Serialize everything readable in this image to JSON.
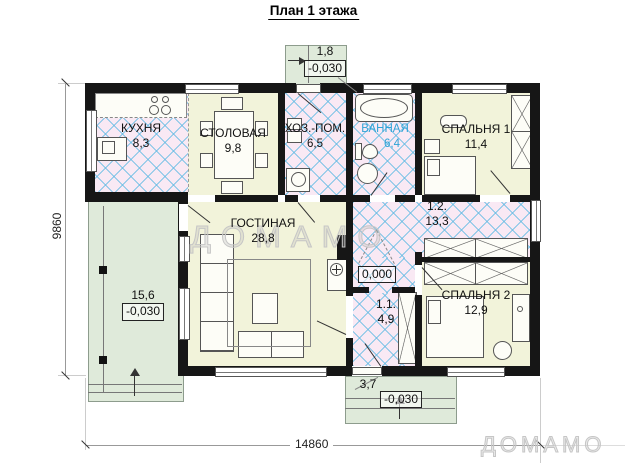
{
  "title": "План 1 этажа",
  "watermark": {
    "text": "ДОМАМО"
  },
  "logo": {
    "text": "ДОМАМО"
  },
  "dimensions": {
    "left_total": "9860",
    "bottom_total": "14860"
  },
  "levels": {
    "zero": "0,000"
  },
  "rooms": {
    "kitchen": {
      "name": "КУХНЯ",
      "area": "8,3"
    },
    "dining": {
      "name": "СТОЛОВАЯ",
      "area": "9,8"
    },
    "utility": {
      "name": "ХОЗ.-ПОМ.",
      "area": "6,5"
    },
    "bathroom": {
      "name": "ВАННАЯ",
      "area": "6,4"
    },
    "bedroom1": {
      "name": "СПАЛЬНЯ 1",
      "area": "11,4"
    },
    "living": {
      "name": "ГОСТИНАЯ",
      "area": "28,8"
    },
    "hall": {
      "name": "1.2.",
      "area": "13,3"
    },
    "vestibule": {
      "name": "1.1.",
      "area": "4,9"
    },
    "bedroom2": {
      "name": "СПАЛЬНЯ 2",
      "area": "12,9"
    },
    "terrace": {
      "area": "15,6",
      "level": "-0,030"
    },
    "porch_top": {
      "width": "1,8",
      "level": "-0,030"
    },
    "porch_bottom": {
      "width": "3,7",
      "level": "-0,030"
    }
  },
  "colors": {
    "accent_blue": "#2ea3d6",
    "hatch_line": "#6ebee4",
    "floor_yellow": "#f2f3da",
    "floor_pink": "#f9e9f4",
    "floor_green": "#dfeada",
    "wall": "#161616"
  }
}
